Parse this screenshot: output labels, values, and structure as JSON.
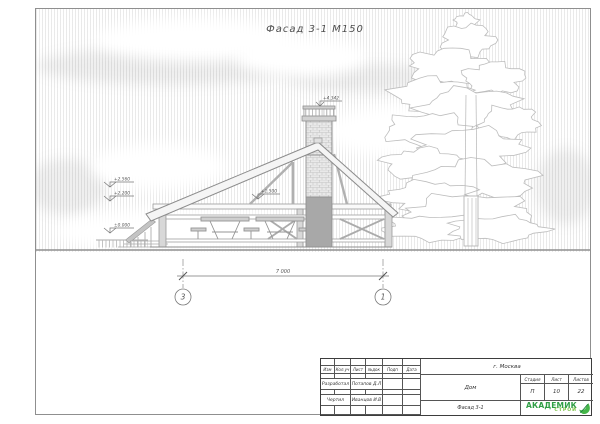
{
  "sheet": {
    "title": "Фасад 3-1  М150"
  },
  "drawing": {
    "elevation_marks": {
      "chimney_top": "+4.342",
      "left_upper": "+2.560",
      "left_lower": "+2.200",
      "center": "+1.500",
      "ground": "±0.000"
    },
    "dimension": {
      "length": "7 000",
      "axis_left": "3",
      "axis_right": "1"
    }
  },
  "title_block": {
    "revision_headers": [
      "Изм",
      "Кол.уч",
      "Лист",
      "№док",
      "Подп",
      "Дата"
    ],
    "rows": [
      {
        "role": "Разработал",
        "name": "Потапов Д.Л"
      },
      {
        "role": "Чертил",
        "name": "Иванцов И.В"
      }
    ],
    "city": "г. Москва",
    "project": "Дом",
    "sheet_name": "Фасад 3-1",
    "stage_header": "Стадия",
    "sheet_header": "Лист",
    "sheets_header": "Листов",
    "stage": "П",
    "sheet_no": "10",
    "sheets_total": "22",
    "logo": {
      "line1": "АКАДЕМИК",
      "line2": "СТРОЙ",
      "color_primary": "#2f9e45",
      "color_secondary": "#7ac143"
    }
  }
}
